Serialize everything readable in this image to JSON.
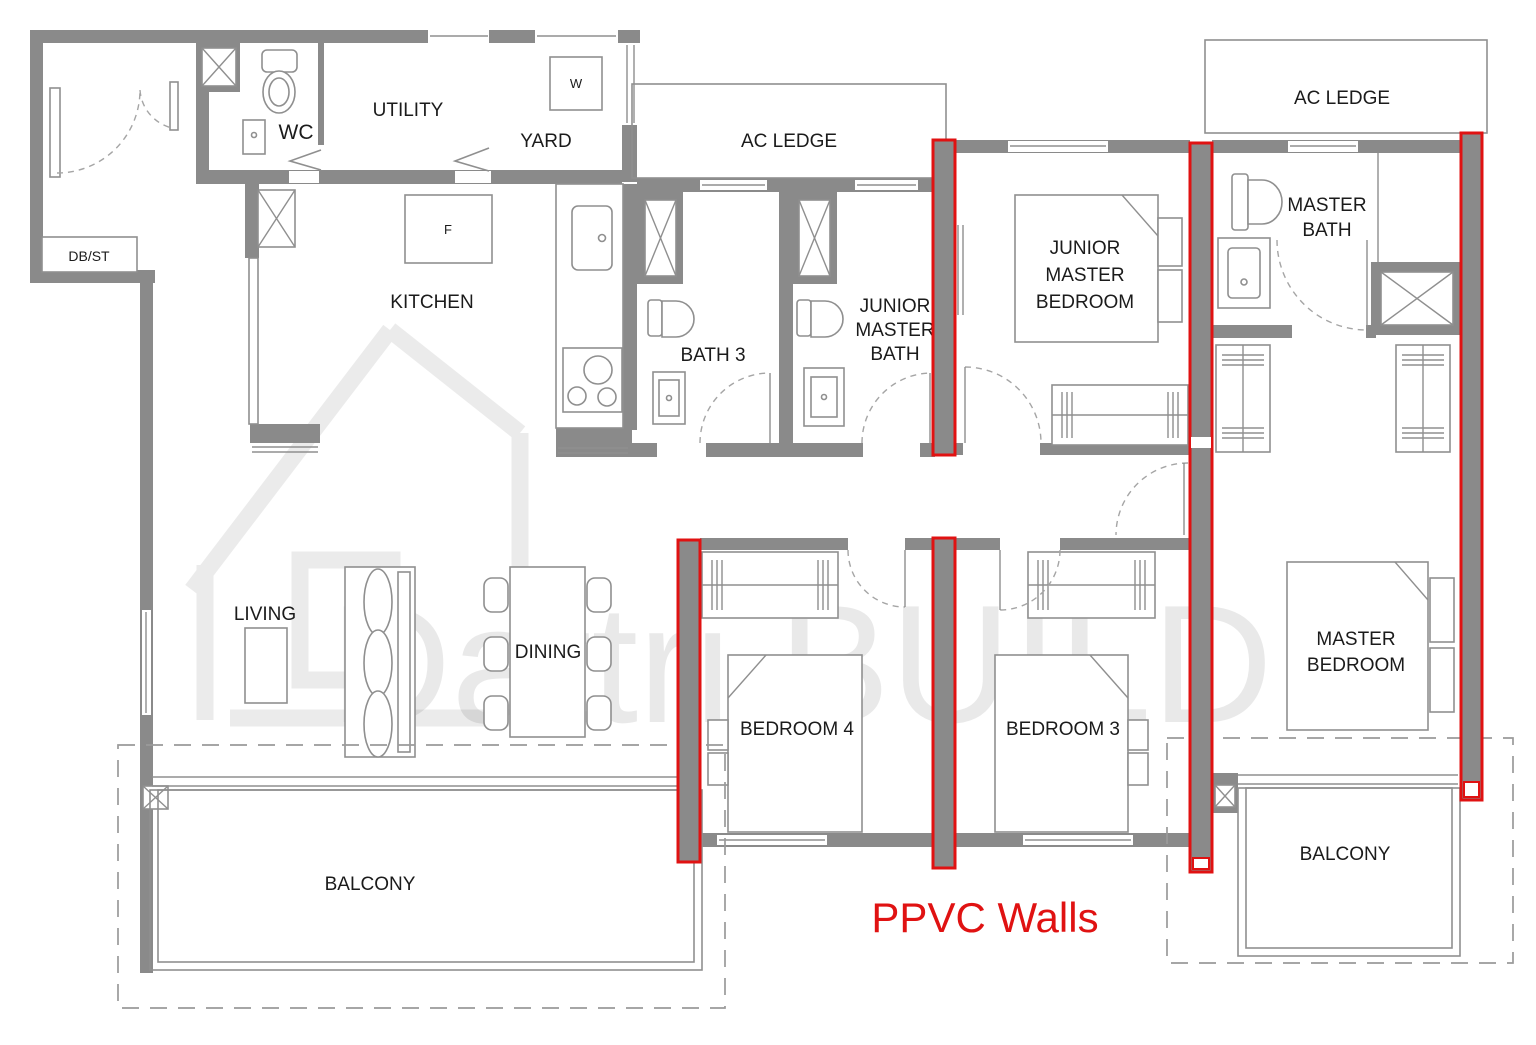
{
  "title": "4-Bedroom Unit Floor Plan with PPVC Walls",
  "labels": {
    "wc": "WC",
    "utility": "UTILITY",
    "yard": "YARD",
    "ac_ledge_top": "AC LEDGE",
    "ac_ledge_right": "AC LEDGE",
    "kitchen": "KITCHEN",
    "db_st": "DB/ST",
    "bath3": "BATH 3",
    "junior_master_bath": {
      "l1": "JUNIOR",
      "l2": "MASTER",
      "l3": "BATH"
    },
    "junior_master_bedroom": {
      "l1": "JUNIOR",
      "l2": "MASTER",
      "l3": "BEDROOM"
    },
    "master_bath": {
      "l1": "MASTER",
      "l2": "BATH"
    },
    "master_bedroom": {
      "l1": "MASTER",
      "l2": "BEDROOM"
    },
    "living": "LIVING",
    "dining": "DINING",
    "bedroom4": "BEDROOM 4",
    "bedroom3": "BEDROOM 3",
    "balcony_left": "BALCONY",
    "balcony_right": "BALCONY"
  },
  "appliances": {
    "washer": "W",
    "fridge": "F"
  },
  "annotation": {
    "ppvc": "PPVC Walls"
  },
  "watermark": {
    "text": "Dattri.BUILD"
  },
  "colors": {
    "wall_gray": "#8a8a8a",
    "ppvc_red": "#e01212",
    "line_gray": "#8f8f8f",
    "label_text": "#1b1b1b",
    "watermark_gray": "rgba(0,0,0,0.08)"
  }
}
